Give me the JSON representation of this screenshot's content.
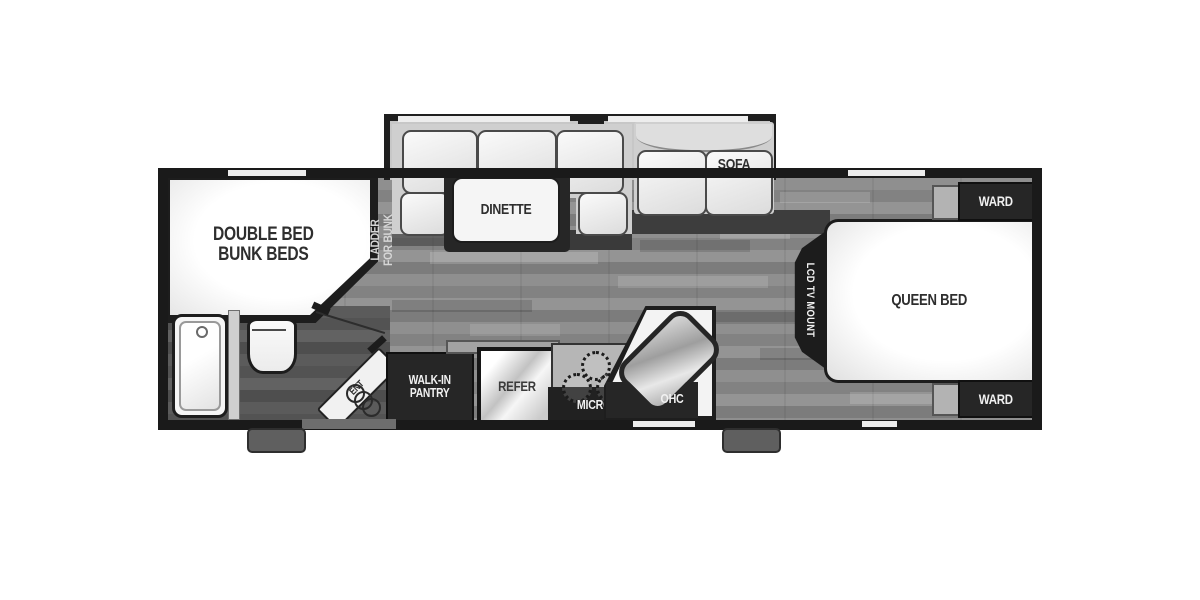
{
  "plan": {
    "bunk_room": {
      "line1": "DOUBLE BED",
      "line2": "BUNK BEDS"
    },
    "ladder_note": {
      "line1": "LADDER",
      "line2": "FOR BUNK"
    },
    "dinette": {
      "label": "DINETTE"
    },
    "sofa": {
      "label": "SOFA"
    },
    "pantry": {
      "line1": "WALK-IN",
      "line2": "PANTRY"
    },
    "refrigerator": {
      "label": "REFER"
    },
    "microwave": {
      "label": "MICRO"
    },
    "overhead_cabinet": {
      "label": "OHC"
    },
    "entry_door": {
      "label": "ENT"
    },
    "tv_mount": {
      "label": "LCD TV MOUNT"
    },
    "queen_bed": {
      "label": "QUEEN BED"
    },
    "wardrobe_top": {
      "label": "WARD"
    },
    "wardrobe_bottom": {
      "label": "WARD"
    }
  },
  "colors": {
    "wall": "#1a1a1a",
    "floor": "#8a8a8a",
    "floor_dark": "#565656",
    "furniture_white": "#f5f5f5",
    "cabinet_dark": "#262626",
    "slide_band": "#c7c7c7",
    "step_gray": "#5f5f5f",
    "label_dark": "#2e2e2e",
    "label_light": "#f1f1f1"
  }
}
